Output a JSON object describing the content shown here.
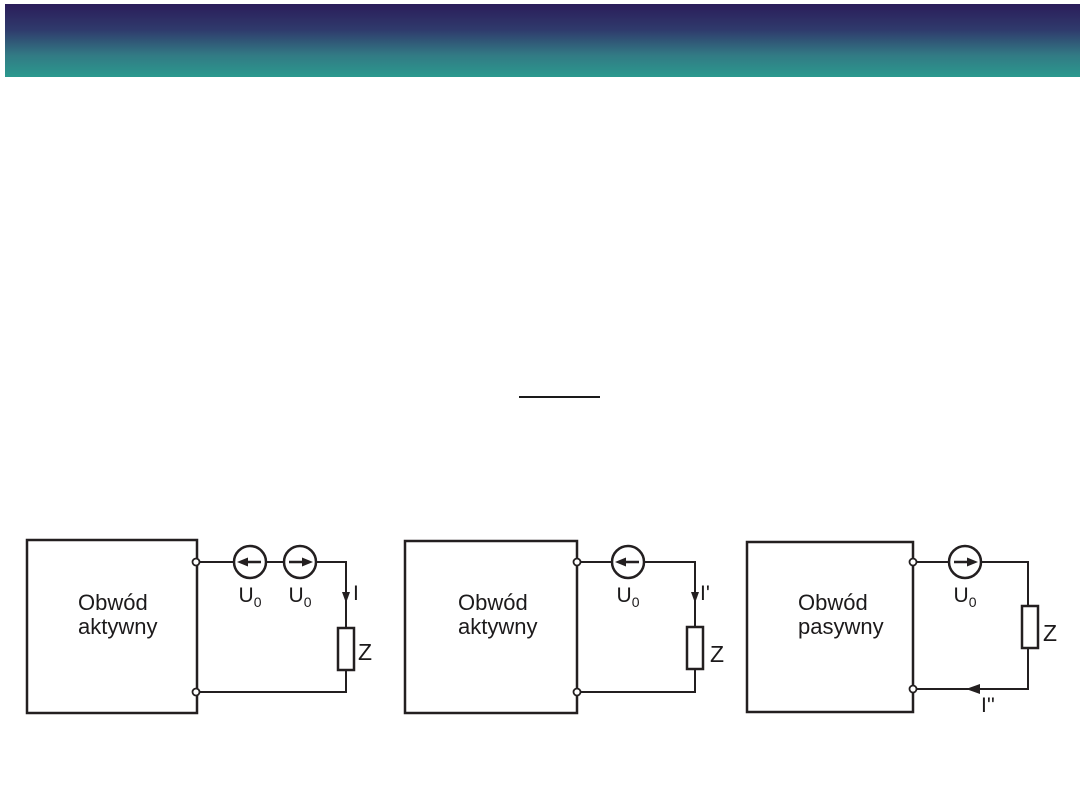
{
  "header": {
    "gradient_stops": [
      "#2b1d5a",
      "#2f3a6c",
      "#327a84",
      "#2b998e"
    ]
  },
  "equation": {
    "fraction_bar_visible": true,
    "fraction_bar_color": "#1a1a1a"
  },
  "ink_color": "#231f20",
  "diagrams": [
    {
      "name": "active-circuit-with-two-opposing-sources",
      "box_label": [
        "Obwód",
        "aktywny"
      ],
      "sources": [
        {
          "label": "U",
          "sub": "0",
          "arrow": "left"
        },
        {
          "label": "U",
          "sub": "0",
          "arrow": "right"
        }
      ],
      "current_label": "I",
      "current_arrow": "down",
      "impedance_label": "Z"
    },
    {
      "name": "active-circuit-single-source",
      "box_label": [
        "Obwód",
        "aktywny"
      ],
      "sources": [
        {
          "label": "U",
          "sub": "0",
          "arrow": "left"
        }
      ],
      "current_label": "I'",
      "current_arrow": "down",
      "impedance_label": "Z"
    },
    {
      "name": "passive-circuit-single-source",
      "box_label": [
        "Obwód",
        "pasywny"
      ],
      "sources": [
        {
          "label": "U",
          "sub": "0",
          "arrow": "right"
        }
      ],
      "current_label": "I''",
      "current_arrow": "left",
      "impedance_label": "Z"
    }
  ]
}
